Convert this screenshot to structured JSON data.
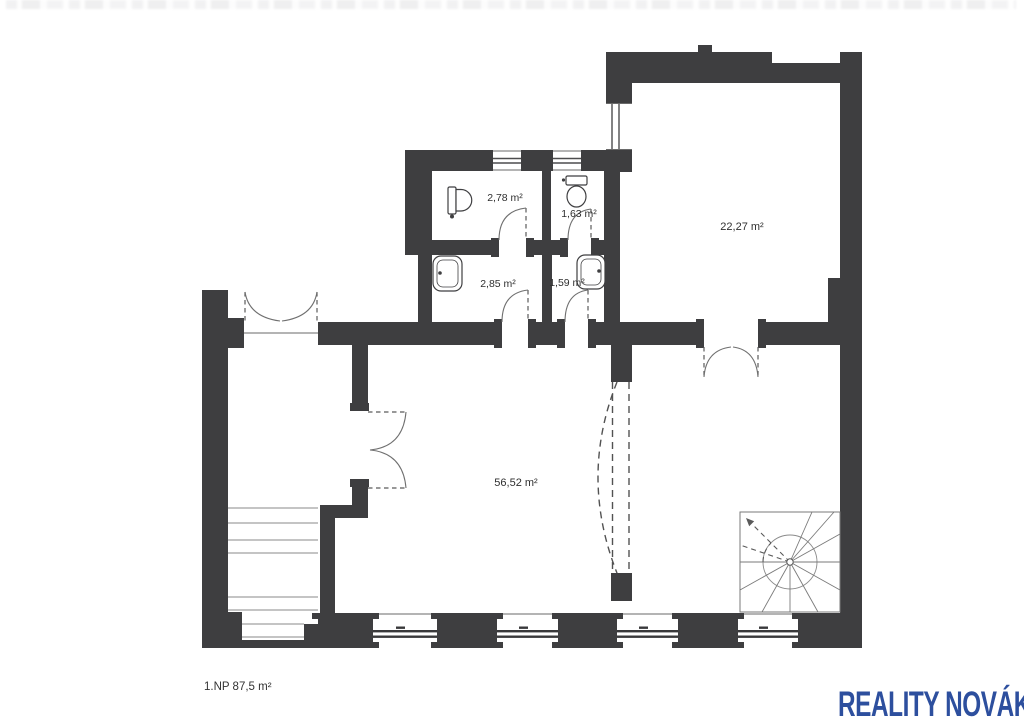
{
  "plan": {
    "floor_label": "1.NP 87,5 m²",
    "rooms": [
      {
        "name": "wc-large",
        "area": "2,78 m²"
      },
      {
        "name": "wc-small",
        "area": "1,63 m²"
      },
      {
        "name": "anteroom-large",
        "area": "2,85 m²"
      },
      {
        "name": "anteroom-small",
        "area": "1,59 m²"
      },
      {
        "name": "room-right",
        "area": "22,27 m²"
      },
      {
        "name": "room-main",
        "area": "56,52 m²"
      }
    ],
    "wall_color": "#3e3e40",
    "line_color": "#6a6a6a",
    "label_color": "#2f2f2f"
  },
  "branding": {
    "logo_text": "REALITY NOVÁK",
    "logo_color": "#2d4f9e"
  }
}
